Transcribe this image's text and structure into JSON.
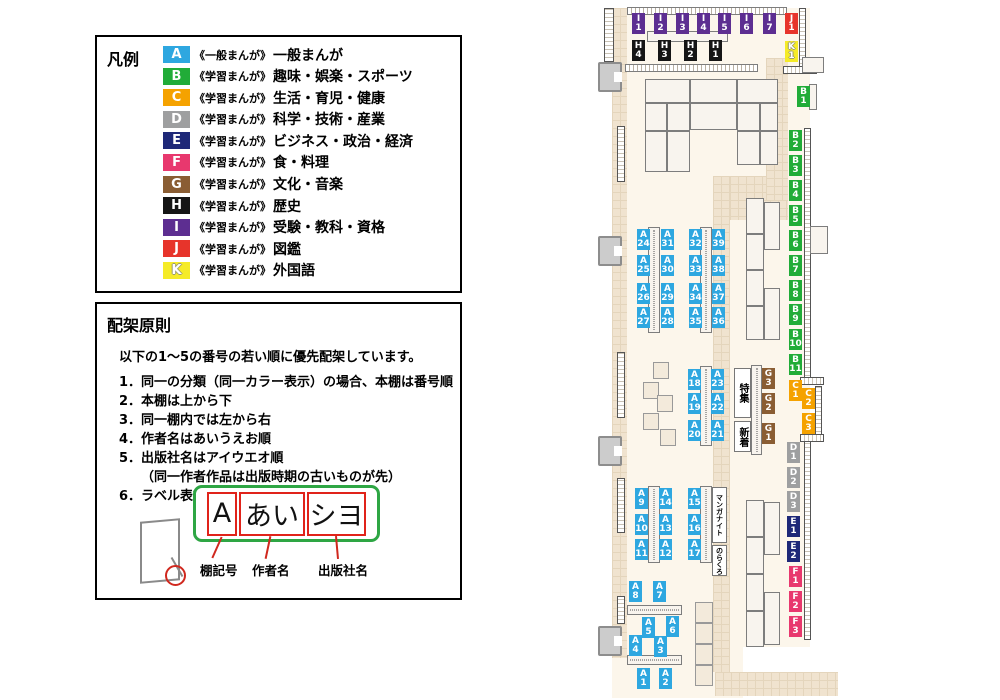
{
  "legend": {
    "title": "凡例",
    "items": [
      {
        "code": "A",
        "tag": "《一般まんが》",
        "label": "一般まんが"
      },
      {
        "code": "B",
        "tag": "《学習まんが》",
        "label": "趣味・娯楽・スポーツ"
      },
      {
        "code": "C",
        "tag": "《学習まんが》",
        "label": "生活・育児・健康"
      },
      {
        "code": "D",
        "tag": "《学習まんが》",
        "label": "科学・技術・産業"
      },
      {
        "code": "E",
        "tag": "《学習まんが》",
        "label": "ビジネス・政治・経済"
      },
      {
        "code": "F",
        "tag": "《学習まんが》",
        "label": "食・料理"
      },
      {
        "code": "G",
        "tag": "《学習まんが》",
        "label": "文化・音楽"
      },
      {
        "code": "H",
        "tag": "《学習まんが》",
        "label": "歴史"
      },
      {
        "code": "I",
        "tag": "《学習まんが》",
        "label": "受験・教科・資格"
      },
      {
        "code": "J",
        "tag": "《学習まんが》",
        "label": "図鑑"
      },
      {
        "code": "K",
        "tag": "《学習まんが》",
        "label": "外国語"
      }
    ]
  },
  "principles": {
    "title": "配架原則",
    "intro": "以下の1～5の番号の若い順に優先配架しています。",
    "items": [
      "1．同一の分類（同一カラー表示）の場合、本棚は番号順",
      "2．本棚は上から下",
      "3．同一棚内では左から右",
      "4．作者名はあいうえお順",
      "5．出版社名はアイウエオ順",
      "（同一作者作品は出版時期の古いものが先）",
      "6．ラベル表記は下図の通り"
    ],
    "example": {
      "boxes": [
        "A",
        "あい",
        "シヨ"
      ],
      "captions": [
        "棚記号",
        "作者名",
        "出版社名"
      ]
    }
  },
  "map": {
    "colors": {
      "A": "#2EA7E0",
      "B": "#21AC38",
      "C": "#F5A200",
      "D": "#9E9FA0",
      "E": "#1E2878",
      "F": "#E8386E",
      "G": "#8A5D33",
      "H": "#151515",
      "I": "#5D2E91",
      "J": "#E7342B",
      "K": "#F5EB27"
    },
    "labels": [
      [
        "I1",
        632,
        13
      ],
      [
        "I2",
        654,
        13
      ],
      [
        "I3",
        676,
        13
      ],
      [
        "I4",
        697,
        13
      ],
      [
        "I5",
        718,
        13
      ],
      [
        "I6",
        740,
        13
      ],
      [
        "I7",
        763,
        13
      ],
      [
        "J1",
        785,
        13
      ],
      [
        "K1",
        785,
        41
      ],
      [
        "H4",
        632,
        40
      ],
      [
        "H3",
        658,
        40
      ],
      [
        "H2",
        684,
        40
      ],
      [
        "H1",
        709,
        40
      ],
      [
        "A24",
        637,
        229
      ],
      [
        "A31",
        661,
        229
      ],
      [
        "A32",
        689,
        229
      ],
      [
        "A39",
        712,
        229
      ],
      [
        "A25",
        637,
        255
      ],
      [
        "A30",
        661,
        255
      ],
      [
        "A33",
        689,
        255
      ],
      [
        "A38",
        712,
        255
      ],
      [
        "A26",
        637,
        283
      ],
      [
        "A29",
        661,
        283
      ],
      [
        "A34",
        689,
        283
      ],
      [
        "A37",
        712,
        283
      ],
      [
        "A27",
        637,
        307
      ],
      [
        "A28",
        661,
        307
      ],
      [
        "A35",
        689,
        307
      ],
      [
        "A36",
        712,
        307
      ],
      [
        "A18",
        688,
        369
      ],
      [
        "A23",
        711,
        369
      ],
      [
        "A19",
        688,
        393
      ],
      [
        "A22",
        711,
        393
      ],
      [
        "A20",
        688,
        420
      ],
      [
        "A21",
        711,
        420
      ],
      [
        "G3",
        762,
        368
      ],
      [
        "G2",
        762,
        393
      ],
      [
        "G1",
        762,
        423
      ],
      [
        "A9",
        635,
        488
      ],
      [
        "A14",
        659,
        488
      ],
      [
        "A10",
        635,
        514
      ],
      [
        "A13",
        659,
        514
      ],
      [
        "A11",
        635,
        539
      ],
      [
        "A12",
        659,
        539
      ],
      [
        "A15",
        688,
        488
      ],
      [
        "A16",
        688,
        514
      ],
      [
        "A17",
        688,
        539
      ],
      [
        "A8",
        629,
        581
      ],
      [
        "A7",
        653,
        581
      ],
      [
        "A5",
        642,
        617
      ],
      [
        "A6",
        666,
        616
      ],
      [
        "A4",
        629,
        635
      ],
      [
        "A3",
        654,
        636
      ],
      [
        "A1",
        637,
        668
      ],
      [
        "A2",
        659,
        668
      ],
      [
        "B1",
        797,
        86
      ],
      [
        "B2",
        789,
        130
      ],
      [
        "B3",
        789,
        155
      ],
      [
        "B4",
        789,
        180
      ],
      [
        "B5",
        789,
        205
      ],
      [
        "B6",
        789,
        230
      ],
      [
        "B7",
        789,
        255
      ],
      [
        "B8",
        789,
        280
      ],
      [
        "B9",
        789,
        304
      ],
      [
        "B10",
        789,
        329
      ],
      [
        "B11",
        789,
        354
      ],
      [
        "C1",
        789,
        380
      ],
      [
        "C2",
        802,
        388
      ],
      [
        "C3",
        802,
        413
      ],
      [
        "D1",
        787,
        442
      ],
      [
        "D2",
        787,
        467
      ],
      [
        "D3",
        787,
        491
      ],
      [
        "E1",
        787,
        516
      ],
      [
        "E2",
        787,
        541
      ],
      [
        "F1",
        789,
        566
      ],
      [
        "F2",
        789,
        591
      ],
      [
        "F3",
        789,
        616
      ]
    ],
    "text_boxes": [
      [
        "特集",
        734,
        368,
        17,
        50,
        10
      ],
      [
        "新着",
        734,
        421,
        17,
        31,
        10
      ],
      [
        "マンガナイト",
        712,
        487,
        15,
        56,
        7
      ],
      [
        "のらくろ",
        712,
        545,
        15,
        31,
        7
      ]
    ],
    "floors": {
      "base": [
        [
          612,
          8,
          198,
          639
        ],
        [
          612,
          645,
          131,
          53
        ]
      ],
      "tile": [
        [
          612,
          8,
          15,
          650
        ],
        [
          713,
          176,
          17,
          496
        ],
        [
          715,
          672,
          123,
          24
        ],
        [
          730,
          176,
          58,
          44
        ],
        [
          766,
          58,
          22,
          142
        ]
      ]
    },
    "shelves": [
      [
        "hatch",
        627,
        7,
        160,
        8
      ],
      [
        "plain",
        647,
        31,
        81,
        11
      ],
      [
        "hatch",
        625,
        64,
        133,
        8
      ],
      [
        "plain",
        645,
        79,
        45,
        24
      ],
      [
        "plain",
        690,
        79,
        47,
        24
      ],
      [
        "plain",
        737,
        79,
        41,
        24
      ],
      [
        "plain",
        645,
        103,
        22,
        28
      ],
      [
        "plain",
        667,
        103,
        23,
        28
      ],
      [
        "plain",
        690,
        103,
        47,
        27
      ],
      [
        "plain",
        737,
        103,
        23,
        28
      ],
      [
        "plain",
        760,
        103,
        18,
        28
      ],
      [
        "plain",
        645,
        131,
        22,
        41
      ],
      [
        "plain",
        667,
        131,
        23,
        41
      ],
      [
        "plain",
        737,
        131,
        23,
        34
      ],
      [
        "plain",
        760,
        131,
        18,
        34
      ],
      [
        "vshelf",
        648,
        227,
        12,
        106
      ],
      [
        "vshelf",
        700,
        227,
        12,
        106
      ],
      [
        "vshelf",
        700,
        366,
        12,
        80
      ],
      [
        "vshelf",
        751,
        365,
        11,
        90
      ],
      [
        "vshelf",
        648,
        486,
        12,
        77
      ],
      [
        "vshelf",
        700,
        486,
        12,
        77
      ],
      [
        "hshelf",
        627,
        605,
        55,
        10
      ],
      [
        "hshelf",
        627,
        655,
        55,
        10
      ],
      [
        "plain",
        746,
        198,
        18,
        36
      ],
      [
        "plain",
        746,
        234,
        18,
        36
      ],
      [
        "plain",
        746,
        270,
        18,
        36
      ],
      [
        "plain",
        746,
        306,
        18,
        34
      ],
      [
        "plain",
        764,
        202,
        16,
        48
      ],
      [
        "plain",
        764,
        288,
        16,
        52
      ],
      [
        "plain",
        746,
        500,
        18,
        37
      ],
      [
        "plain",
        746,
        537,
        18,
        37
      ],
      [
        "plain",
        746,
        574,
        18,
        37
      ],
      [
        "plain",
        746,
        611,
        18,
        36
      ],
      [
        "plain",
        764,
        502,
        16,
        53
      ],
      [
        "plain",
        764,
        592,
        16,
        53
      ],
      [
        "plain",
        809,
        84,
        8,
        26
      ],
      [
        "plain",
        802,
        57,
        22,
        16
      ],
      [
        "plain",
        810,
        226,
        18,
        28
      ],
      [
        "beige",
        653,
        362,
        16,
        17
      ],
      [
        "beige",
        643,
        382,
        16,
        17
      ],
      [
        "beige",
        657,
        395,
        16,
        17
      ],
      [
        "beige",
        643,
        413,
        16,
        17
      ],
      [
        "beige",
        660,
        429,
        16,
        17
      ],
      [
        "beige",
        695,
        602,
        18,
        21
      ],
      [
        "beige",
        695,
        623,
        18,
        21
      ],
      [
        "beige",
        695,
        644,
        18,
        21
      ],
      [
        "beige",
        695,
        665,
        18,
        21
      ]
    ],
    "walls": [
      [
        "v",
        604,
        8,
        10,
        54
      ],
      [
        "v",
        617,
        126,
        8,
        56
      ],
      [
        "v",
        617,
        352,
        8,
        66
      ],
      [
        "v",
        617,
        478,
        8,
        55
      ],
      [
        "v",
        617,
        596,
        8,
        28
      ],
      [
        "v",
        799,
        8,
        7,
        60
      ],
      [
        "v",
        804,
        128,
        7,
        252
      ],
      [
        "v",
        804,
        440,
        7,
        200
      ],
      [
        "v",
        815,
        386,
        7,
        50
      ],
      [
        "h",
        783,
        66,
        34,
        8
      ],
      [
        "h",
        800,
        377,
        24,
        8
      ],
      [
        "h",
        800,
        434,
        24,
        8
      ]
    ],
    "doors": [
      [
        598,
        62
      ],
      [
        598,
        236
      ],
      [
        598,
        436
      ],
      [
        598,
        626
      ]
    ]
  }
}
